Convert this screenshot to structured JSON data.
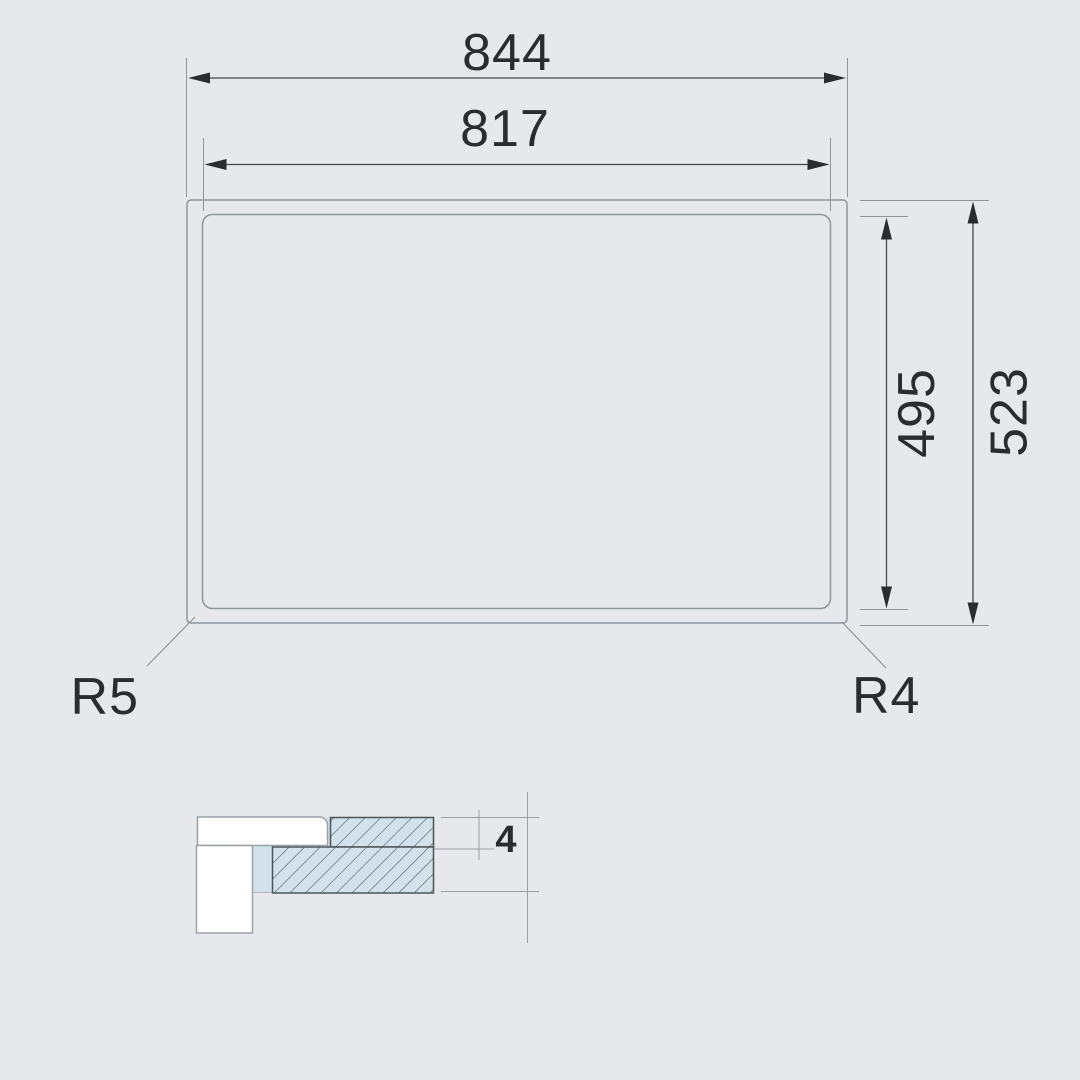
{
  "drawing": {
    "kind": "appliance-cutout-dimension-drawing",
    "views": [
      "top-view",
      "edge-section-detail"
    ]
  },
  "dimensions": {
    "outer_width": "844",
    "inner_width": "817",
    "inner_height": "495",
    "outer_height": "523",
    "panel_thickness": "4"
  },
  "corner_radii": {
    "bottom_left": "R5",
    "bottom_right": "R4"
  },
  "colors": {
    "background": "#e6e8eb",
    "outline": "#8e959b",
    "dimension_line": "#44484c",
    "text": "#2a2d30",
    "section_fill": "#d3e2ea",
    "hatch_line": "#5a6670",
    "section_outline": "#4c545a",
    "profile_fill": "#ffffff"
  }
}
